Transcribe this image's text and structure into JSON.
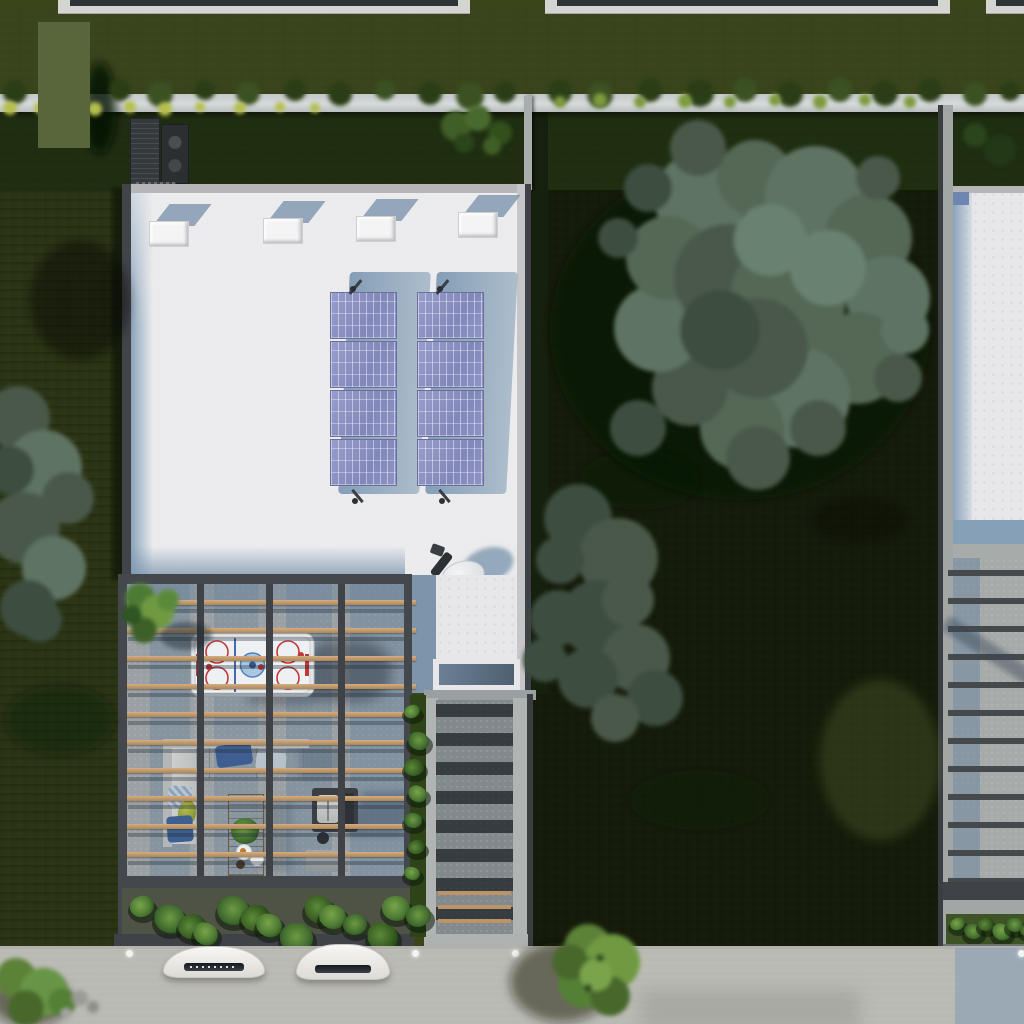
{
  "scene": {
    "type": "aerial-architectural-render",
    "description": "Top-down 3D rendering of a modern flat-roof row house with rooftop solar panels, HVAC units and a satellite dish, a wood-slatted pergola terrace containing an air-hockey table, outdoor sofa, coffee table and grill, a shaded side walkway, lawns with large trees, a neighbouring roof deck, and a front street with two parked white cars and round bushes.",
    "objects": [
      "flat-roof-house",
      "solar-array",
      "hvac-unit",
      "satellite-dish",
      "pergola",
      "air-hockey-table",
      "outdoor-sofa",
      "coffee-table",
      "grill-station",
      "side-walkway",
      "neighbor-roof",
      "neighbor-deck",
      "street",
      "car",
      "bush",
      "tree",
      "lawn",
      "boundary-wall",
      "privacy-marker"
    ]
  },
  "colors": {
    "grass": "#4c5a23",
    "grass_dark": "#19230f",
    "grass_bright": "#5f7030",
    "hedge": "#141d0d",
    "foliage": "#566a5a",
    "foliage_dark": "#3e4c40",
    "bush": "#5c8237",
    "roof": "#e7e7e9",
    "parapet": "#b6b6b8",
    "shadow_blue": "#849fb8",
    "panel": "#8d92c3",
    "panel_frame": "#6a6f9e",
    "wood": "#c49d72",
    "frame": "#45494d",
    "concrete": "#9aa0a3",
    "corridor_dark": "#23282c",
    "road": "#c8c8c2",
    "wall": "#ccd1d2",
    "white_unit": "#f4f4f4",
    "glass": "#5f7080",
    "rink_red": "#c23737",
    "rink_blue": "#4a6ab0",
    "rink_ice": "#eef1f4",
    "pillow_blue": "#3e5e92",
    "sofa": "#c7c9c9",
    "car": "#f2f2f0",
    "marker": "#59663c"
  },
  "counts": {
    "hvac_units": 4,
    "solar_arrays": 2,
    "panels_per_array": 4,
    "pergola_slats": 11,
    "pergola_beams": 3,
    "walkway_shadow_stripes": 8,
    "neighbor_beams": 12,
    "cars": 2,
    "path_lights": 4
  },
  "top_edges": [
    {
      "x": 58,
      "w": 412,
      "ix": 70,
      "iw": 388
    },
    {
      "x": 545,
      "w": 405,
      "ix": 557,
      "iw": 381
    },
    {
      "x": 986,
      "w": 38,
      "ix": 996,
      "iw": 28
    }
  ],
  "hvac": {
    "w": 38,
    "h": 24,
    "units": [
      [
        149,
        221
      ],
      [
        263,
        218
      ],
      [
        356,
        216
      ],
      [
        458,
        212
      ]
    ]
  },
  "solar": {
    "w": 67,
    "ph": 47,
    "gap": 2,
    "n": 4,
    "arrays": [
      [
        330,
        292
      ],
      [
        417,
        292
      ]
    ]
  },
  "pergola": {
    "slat_x": 124,
    "slat_w": 284,
    "y0": 600,
    "dy": 28,
    "n": 11,
    "beams_x": [
      197,
      266,
      338
    ],
    "beam_y": 584,
    "beam_h": 350
  },
  "walkway": {
    "x": 436,
    "w": 77,
    "y0": 704,
    "dy": 29,
    "n": 8,
    "wood_y": [
      891,
      905,
      919
    ]
  },
  "neighbor_beams": {
    "x": 948,
    "w": 76,
    "y0": 570,
    "dy": 28,
    "n": 12
  },
  "planter_main": {
    "x0": 130,
    "y": 896,
    "dx": 21,
    "n": 14
  },
  "planter_side": {
    "x": 404,
    "y0": 705,
    "dy": 27,
    "n": 7
  },
  "planter_neighbor": {
    "x0": 950,
    "y": 918,
    "dx": 14,
    "n": 6
  },
  "lights_x": [
    126,
    412,
    512,
    1018
  ],
  "cars": [
    {
      "x": 163,
      "y": 946,
      "w": 100,
      "h": 30
    },
    {
      "x": 296,
      "y": 944,
      "w": 92,
      "h": 34
    }
  ],
  "privacy_marker": {
    "x": 38,
    "y": 22,
    "w": 52,
    "h": 126
  }
}
